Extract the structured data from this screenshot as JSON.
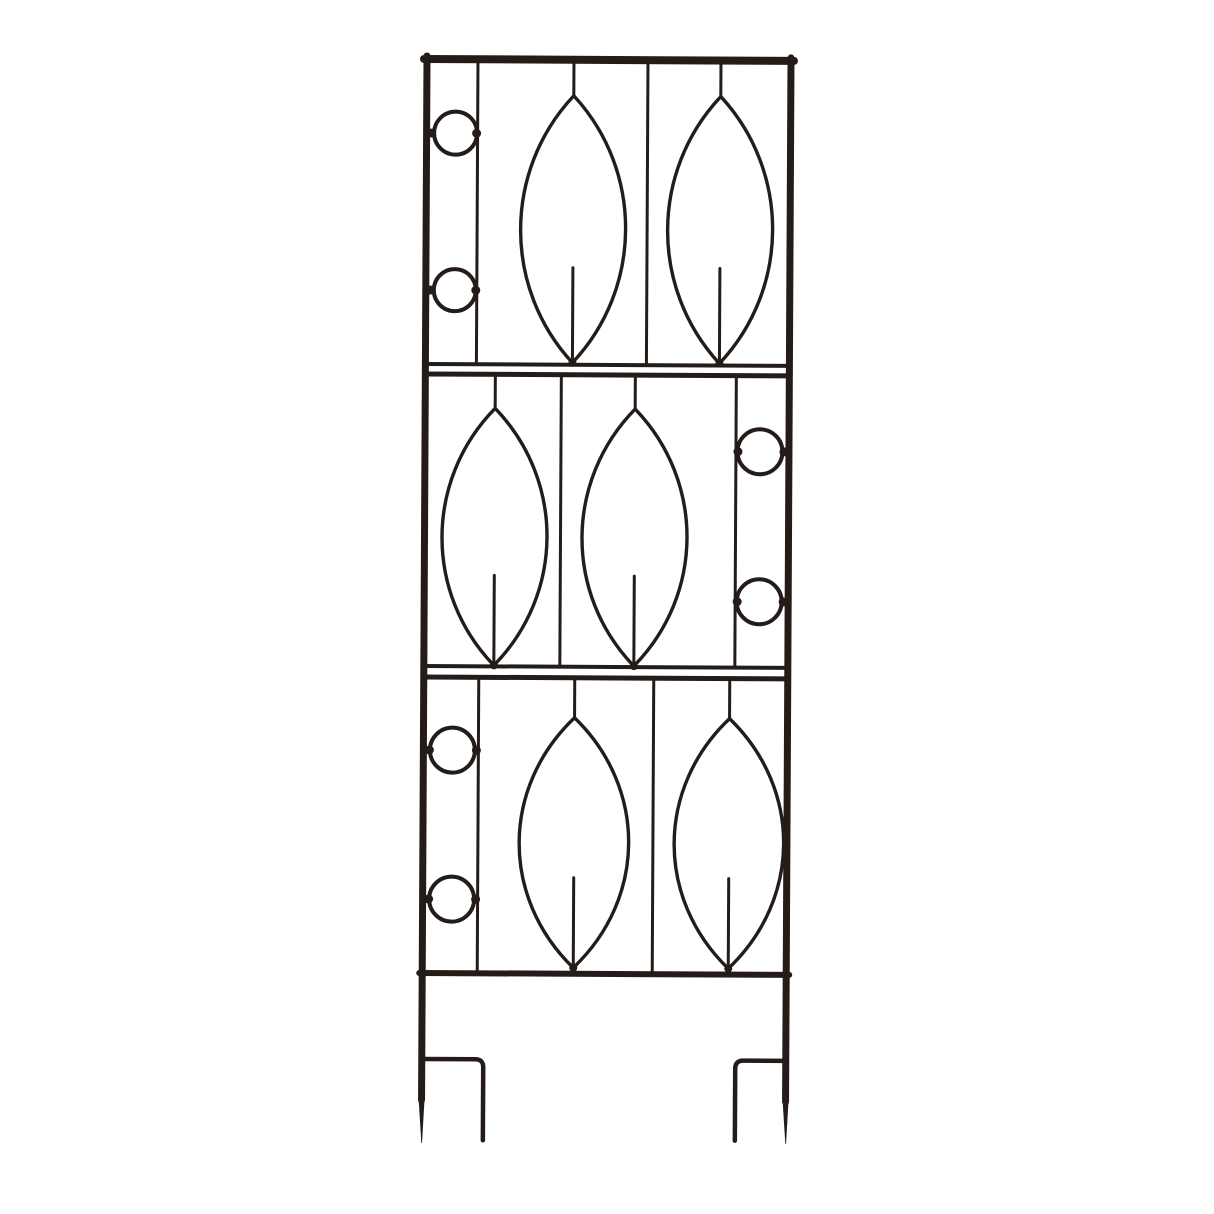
{
  "scene": {
    "type": "product-photo",
    "subject": "Black wrought-iron garden trellis with leaf and ring ornaments and two ground stakes",
    "background": "#ffffff"
  },
  "colors": {
    "metal": "#231c18",
    "metal_thin": "#2b231e",
    "background": "#ffffff"
  },
  "trellis": {
    "panel_count": 3,
    "panels": [
      {
        "id": "top",
        "rings_side": "left",
        "ring_count": 2,
        "leaf_count": 2
      },
      {
        "id": "middle",
        "rings_side": "right",
        "ring_count": 2,
        "leaf_count": 2
      },
      {
        "id": "bottom",
        "rings_side": "left",
        "ring_count": 2,
        "leaf_count": 2
      }
    ],
    "legs": {
      "stake_count": 2,
      "prong_count": 2
    }
  }
}
